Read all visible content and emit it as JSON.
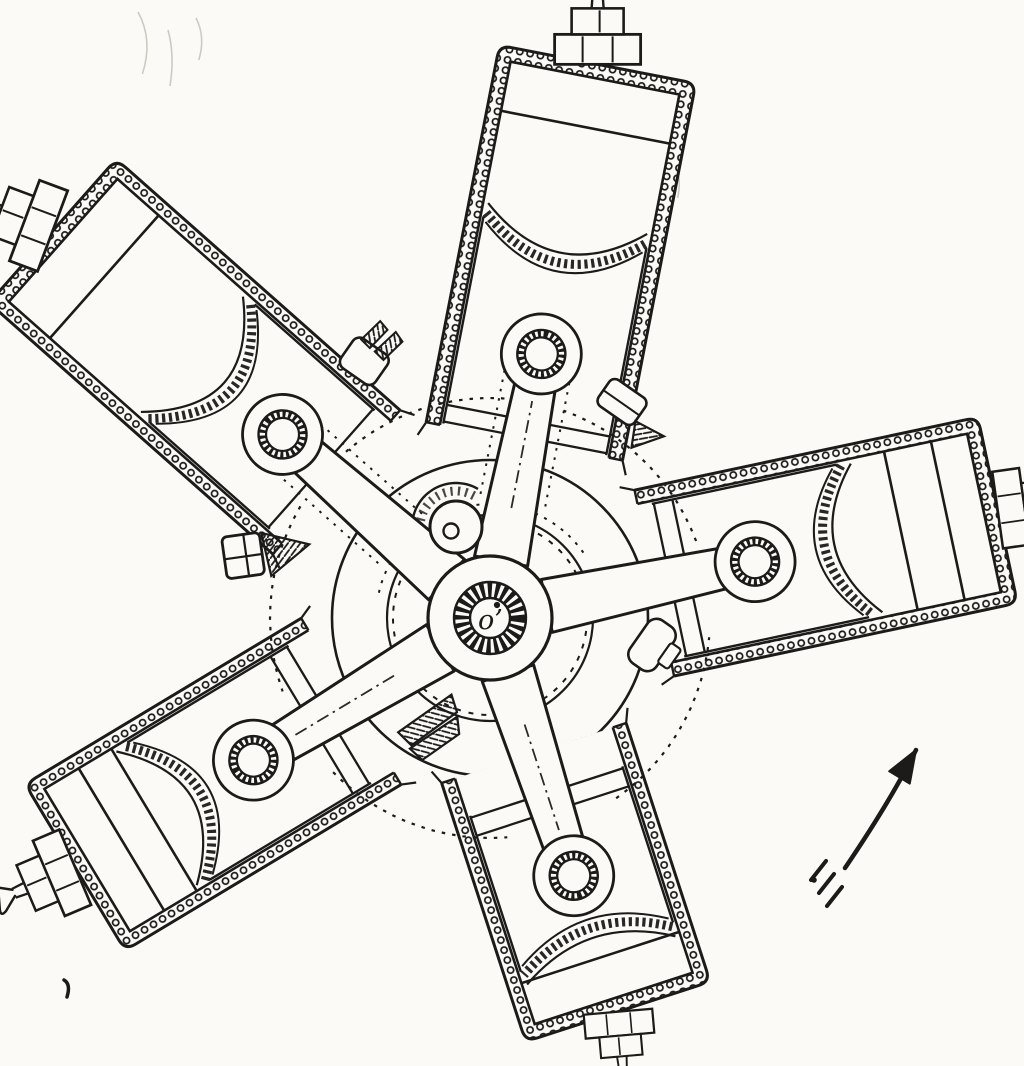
{
  "title": "Radial engine cross-section diagram",
  "colors": {
    "background": "#fbfaf6",
    "ink": "#1c1b19",
    "faint": "#b5b1a6"
  },
  "canvas": {
    "width": 1024,
    "height": 1066
  },
  "hub": {
    "cx": 490,
    "cy": 618,
    "label": "o’",
    "outer_r": 62,
    "ring_outer_r": 36,
    "ring_inner_r": 20,
    "dot": {
      "x": 497,
      "y": 605,
      "r": 3.1
    }
  },
  "crank": {
    "pin": {
      "x": 456,
      "y": 527,
      "r": 26,
      "hole_x": 451,
      "hole_y": 531,
      "hole_r": 7.5
    },
    "counterweight": {
      "r": 44,
      "speckle_r": 36,
      "from_deg": 60,
      "to_deg": 285
    },
    "dashed_circle_r": 97,
    "disc_r": 103,
    "hidden_arc": {
      "r": 114,
      "from_deg": 35,
      "to_deg": 170
    }
  },
  "crankcase": {
    "r": 158,
    "hidden_arc_r": 220,
    "junction_angles": [
      45.5,
      108.5,
      174.5,
      249.5,
      330
    ],
    "junction_half_span": 25
  },
  "cylinders": [
    {
      "id": "top",
      "angle": 79,
      "r0": 180,
      "length": 550,
      "half_width": 100,
      "wall": 14,
      "pin": 269,
      "crown_edge": 397,
      "crown_apex": 362,
      "head_chords": [
        500
      ],
      "skirt_chords": [
        201,
        184
      ],
      "plug_scale": 1.0,
      "plug_tilt": -11,
      "centerline": true,
      "side_dots": true
    },
    {
      "id": "upper-left",
      "angle": 138.5,
      "r0": 205,
      "length": 570,
      "half_width": 96,
      "wall": 14,
      "pin": 277,
      "crown_edge": 388,
      "crown_apex": 345,
      "head_chords": [
        515
      ],
      "skirt_chords": [
        226
      ],
      "plug_scale": 1.0,
      "plug_tilt": -21,
      "centerline": false,
      "side_dots": true
    },
    {
      "id": "right",
      "angle": 12,
      "r0": 168,
      "length": 505,
      "half_width": 95,
      "wall": 14,
      "pin": 271,
      "crown_edge": 375,
      "crown_apex": 342,
      "head_chords": [
        468,
        420
      ],
      "skirt_chords": [
        203,
        184
      ],
      "plug_scale": 0.9,
      "plug_tilt": 4,
      "centerline": false,
      "side_dots": false
    },
    {
      "id": "bottom-left",
      "angle": 211,
      "r0": 162,
      "length": 470,
      "half_width": 97,
      "wall": 14,
      "pin": 276,
      "crown_edge": 379,
      "crown_apex": 338,
      "head_chords": [
        430,
        392
      ],
      "skirt_chords": [
        208,
        189
      ],
      "plug_scale": 0.95,
      "plug_tilt": 8,
      "centerline": true,
      "side_dots": false
    },
    {
      "id": "bottom-right",
      "angle": 288,
      "r0": 142,
      "length": 400,
      "half_width": 97,
      "wall": 14,
      "pin": 271,
      "crown_edge": 350,
      "crown_apex": 326,
      "head_chords": [
        357
      ],
      "skirt_chords": [
        203,
        184
      ],
      "plug_scale": 0.8,
      "plug_tilt": 13,
      "centerline": true,
      "side_dots": false
    }
  ],
  "wrist_pin": {
    "boss_r": 40,
    "ring_outer_r": 24,
    "ring_inner_r": 16.5
  },
  "rod": {
    "start": 58,
    "hub_half": 27,
    "pin_half": 19
  },
  "plug": {
    "base_depth": 30,
    "base_half": 43,
    "mid_depth": 26,
    "mid_half": 26,
    "stem": 14
  },
  "hardware": [
    {
      "id": "clamp-top-left",
      "x": 372,
      "y": 352,
      "rot": -55,
      "type": "clamp"
    },
    {
      "id": "nut-top-right",
      "x": 622,
      "y": 402,
      "rot": 35,
      "type": "nut-wedge"
    },
    {
      "id": "bolt-left",
      "x": 262,
      "y": 553,
      "rot": -8,
      "type": "bolt-wedge"
    },
    {
      "id": "bracket-bottom",
      "x": 428,
      "y": 722,
      "rot": 60,
      "type": "fingers"
    },
    {
      "id": "nut-bottom-right",
      "x": 652,
      "y": 645,
      "rot": -55,
      "type": "blob"
    }
  ],
  "arrow": {
    "tail": {
      "x": 845,
      "y": 868
    },
    "tip": {
      "x": 916,
      "y": 750
    },
    "head_len": 32,
    "head_half": 12,
    "fletch": [
      [
        826,
        861
      ],
      [
        834,
        874
      ],
      [
        842,
        887
      ]
    ],
    "dot": {
      "x": 814,
      "y": 880,
      "r": 2.8
    }
  },
  "marks": {
    "comma": {
      "x": 64,
      "y": 980
    },
    "smudges": [
      [
        138,
        12,
        22,
        62
      ],
      [
        168,
        30,
        10,
        56
      ],
      [
        196,
        18,
        14,
        42
      ],
      [
        676,
        166,
        8,
        32
      ]
    ]
  }
}
